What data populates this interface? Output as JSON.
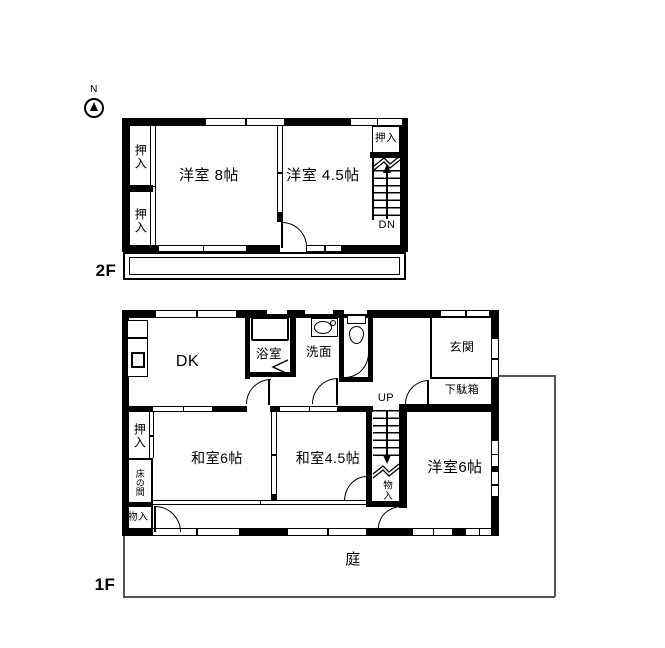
{
  "compass": {
    "north_label": "N"
  },
  "floor2": {
    "floor_label": "2F",
    "rooms": {
      "yoshitsu8": "洋室 8帖",
      "yoshitsu45": "洋室 4.5帖",
      "closet_left_top": "押入",
      "closet_left_bottom": "押入",
      "closet_right": "押入"
    },
    "stairs": {
      "down_label": "DN"
    }
  },
  "floor1": {
    "floor_label": "1F",
    "rooms": {
      "dk": "DK",
      "bath": "浴室",
      "washroom": "洗面",
      "entrance": "玄関",
      "shoe_cabinet": "下駄箱",
      "closet": "押入",
      "tokonoma": "床の間",
      "storage_bottom_left": "物入",
      "washitsu6": "和室6帖",
      "washitsu45": "和室4.5帖",
      "storage_by_stairs": "物入",
      "yoshitsu6": "洋室6帖"
    },
    "stairs": {
      "up_label": "UP"
    },
    "garden_label": "庭"
  },
  "colors": {
    "wall": "#000000",
    "background": "#ffffff",
    "garden_boundary": "#555555"
  }
}
